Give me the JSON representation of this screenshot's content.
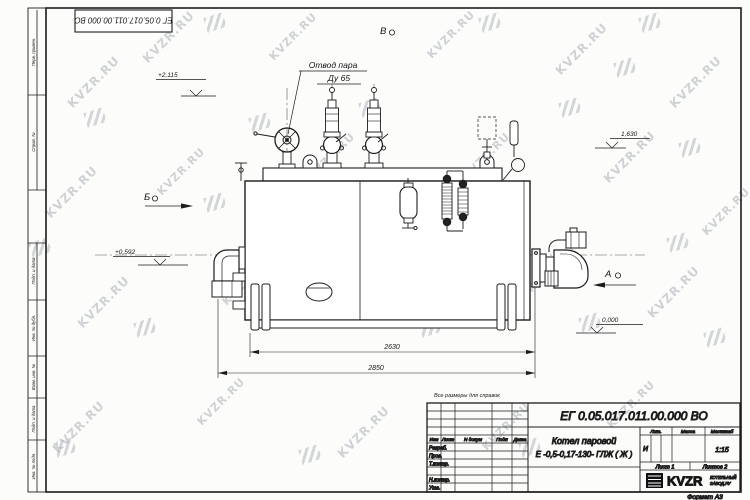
{
  "watermark": {
    "text": "KVZR.RU"
  },
  "corner_stamp": {
    "designation": "ЕГ 0.05.017.011.00.000  ВО"
  },
  "margin_labels": {
    "c1": "Перв. примен.",
    "c2": "Справ. №",
    "c3": "Подп. и дата",
    "c4": "Инв. № дубл.",
    "c5": "Взам. инв. №",
    "c6": "Подп. и дата",
    "c7": "Инв. № подл."
  },
  "drawing": {
    "note": "Все размеры для справок",
    "steam_outlet": {
      "line1": "Отвод пара",
      "line2": "Ду 65"
    },
    "views": {
      "a": "А",
      "b": "Б",
      "v": "В"
    },
    "elevations": {
      "top": "+2,115",
      "mid": "1,630",
      "burner": "+0,592",
      "zero": "0,000"
    },
    "dimensions": {
      "inner": "2630",
      "outer": "2850"
    }
  },
  "title_block": {
    "designation": "ЕГ 0.05.017.011.00.000  ВО",
    "name_line1": "Котел паровой",
    "name_line2": "Е -0,5-0,17-130- ГЛЖ ( Ж )",
    "cols": {
      "izm": "Изм",
      "list": "Лист",
      "ndoc": "N докум",
      "podp": "Подп",
      "data": "Дата"
    },
    "rows": {
      "r1": "Разраб.",
      "r2": "Пров.",
      "r3": "Т.контр.",
      "r5": "Н.контр.",
      "r6": "Утв."
    },
    "lit": {
      "header": "Лит.",
      "value": "И"
    },
    "mass": {
      "header": "Масса"
    },
    "scale": {
      "header": "Масштаб",
      "value": "1:15"
    },
    "sheet": "Лист 1",
    "sheets": "Листов 2",
    "logo": {
      "text": "KVZR",
      "sub1": "КОТЕЛЬНЫЙ",
      "sub2": "ЗАВОД.РУ"
    },
    "format": "Формат А3"
  }
}
